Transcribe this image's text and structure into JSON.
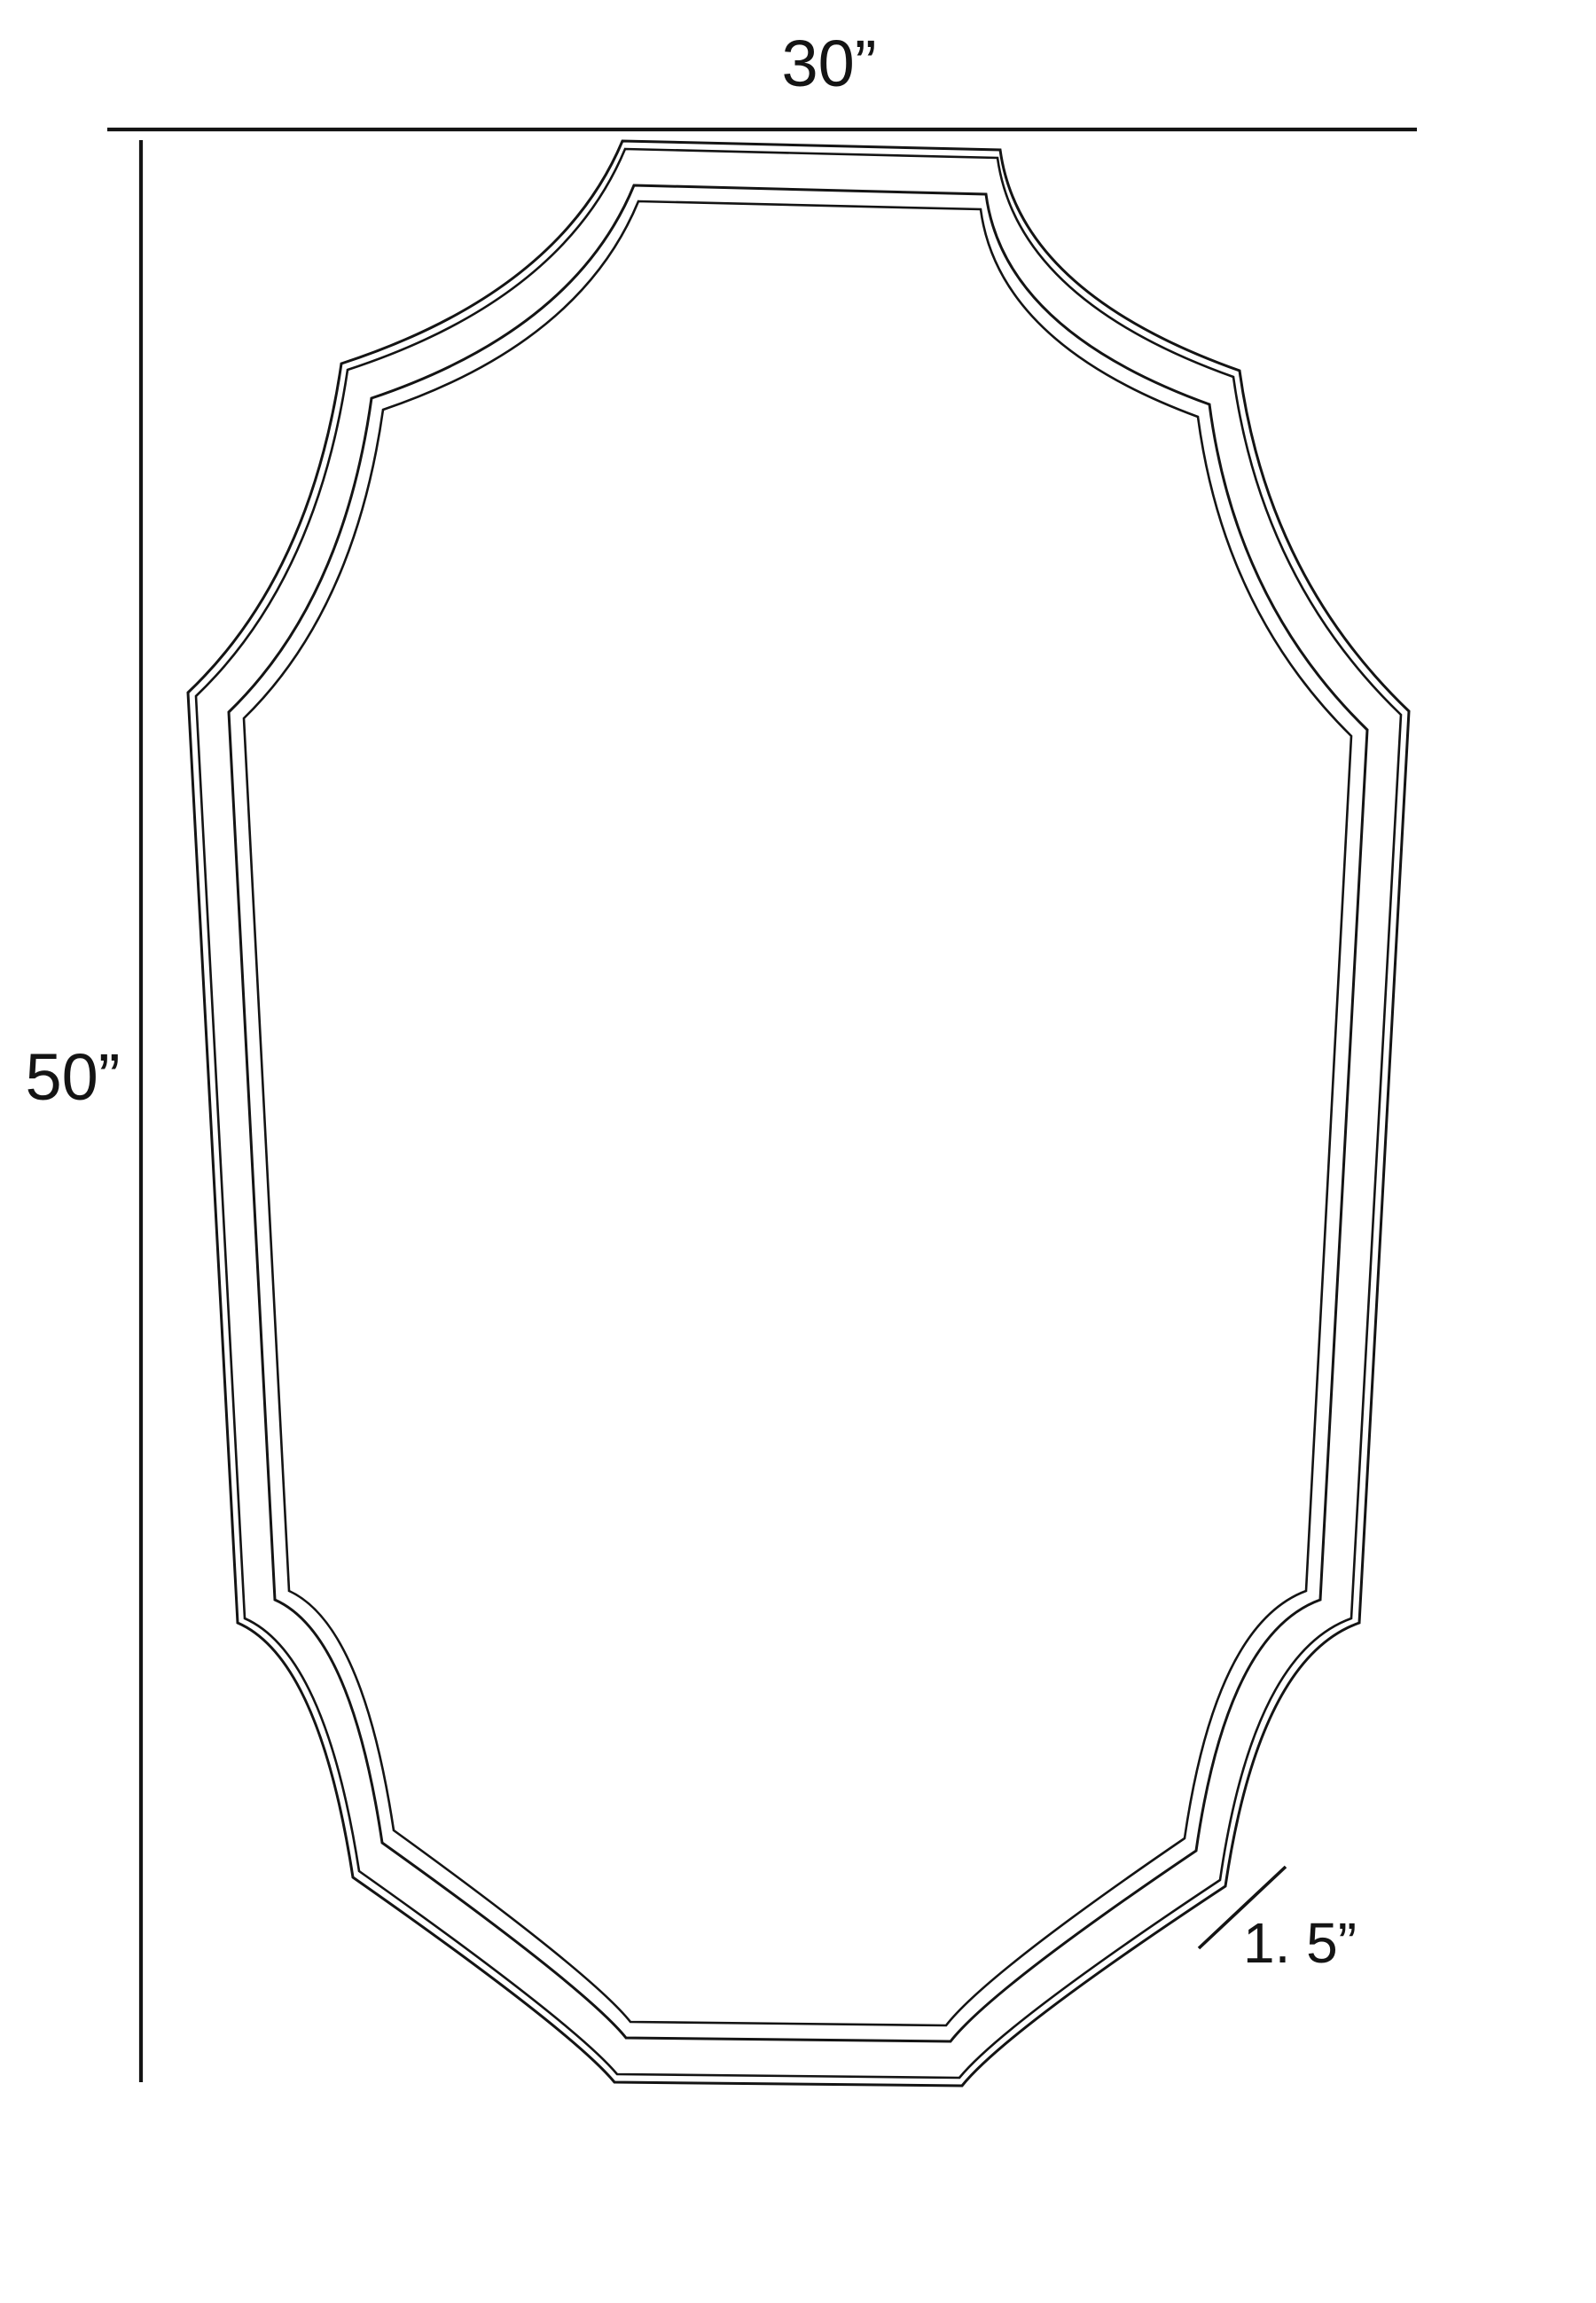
{
  "diagram": {
    "type": "product-dimension-drawing",
    "subject": "scalloped rectangular wall mirror, front elevation",
    "background_color": "#ffffff",
    "line_color": "#141414",
    "labels": {
      "width": "30”",
      "height": "50”",
      "depth": "1. 5”"
    },
    "measurements": {
      "width_inches": 30,
      "height_inches": 50,
      "frame_depth_inches": 1.5
    },
    "shapes": {
      "outer": "M 702 159 L 1128 169 Q 1150 330 1398 418 Q 1430 650 1589 802 L 1533 1830 Q 1420 1870 1382 2127 Q 1135 2290 1085 2352 L 693 2348 Q 645 2290 398 2117 Q 360 1870 268 1830 L 212 781 Q 350 650 385 410 Q 630 330 702 159 Z",
      "bevel": "M 705 168 L 1125 178 Q 1147 338 1391 425 Q 1423 655 1580 806 L 1524 1825 Q 1413 1865 1376 2120 Q 1132 2282 1082 2343 L 696 2339 Q 648 2282 405 2110 Q 367 1865 276 1825 L 221 785 Q 357 655 392 417 Q 634 338 705 168 Z",
      "inner": "M 715 209 L 1112 219 Q 1132 372 1364 456 Q 1393 678 1542 823 L 1489 1804 Q 1384 1842 1349 2087 Q 1118 2243 1072 2302 L 706 2298 Q 662 2243 431 2078 Q 396 1842 310 1804 L 258 803 Q 387 678 419 449 Q 648 372 715 209 Z",
      "innermost": "M 720 227 L 1106 236 Q 1126 387 1351 470 Q 1380 688 1524 830 L 1473 1794 Q 1371 1832 1336 2073 Q 1112 2226 1067 2284 L 711 2280 Q 668 2226 444 2064 Q 409 1832 326 1794 L 275 810 Q 400 688 432 462 Q 654 387 720 227 Z",
      "width_dim_line": "M 121 146 L 1598 146",
      "height_dim_line": "M 159 158 L 159 2348",
      "depth_leader_line": "M 1352 2197 L 1450 2105"
    }
  }
}
